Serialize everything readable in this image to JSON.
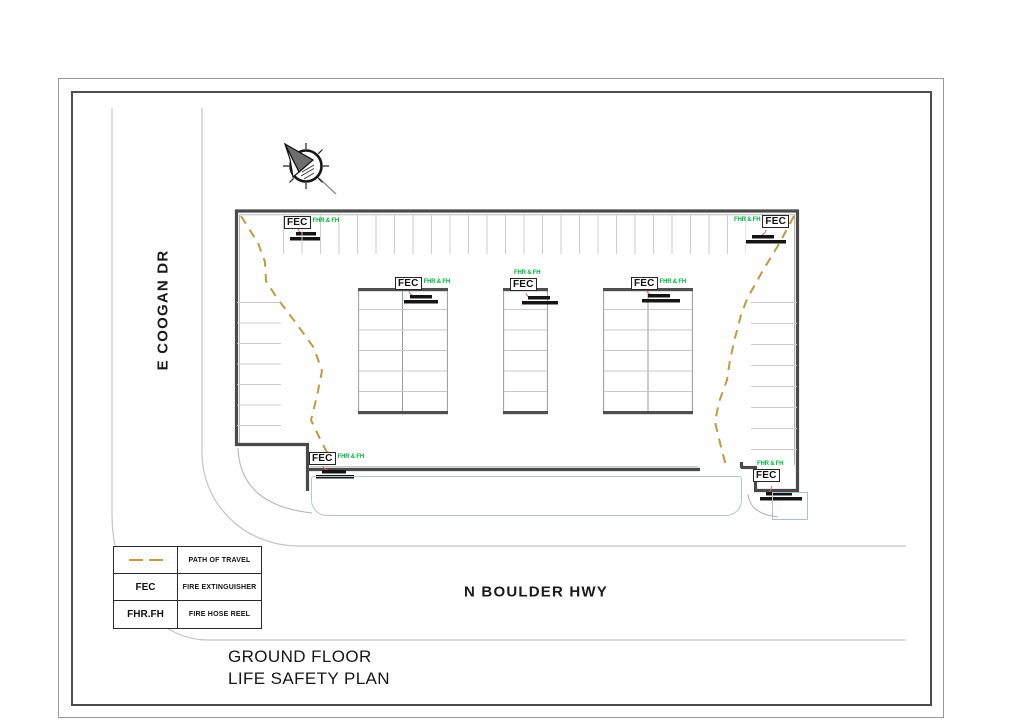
{
  "plan": {
    "streets": {
      "left_street": "E COOGAN DR",
      "bottom_street": "N BOULDER HWY"
    },
    "title_line1": "GROUND FLOOR",
    "title_line2": "LIFE SAFETY PLAN"
  },
  "fec": {
    "label": "FEC",
    "tag": "FHR & FH"
  },
  "legend": {
    "rows": [
      {
        "symbol": "dashed-line",
        "label": "PATH OF TRAVEL"
      },
      {
        "symbol": "FEC",
        "label": "FIRE EXTINGUISHER"
      },
      {
        "symbol": "FHR.FH",
        "label": "FIRE HOSE REEL"
      }
    ]
  },
  "colors": {
    "path_of_travel": "#c19a3f",
    "fec_tag_green": "#00b33c",
    "leader_red": "#e06666",
    "wall": "#4f4f4f",
    "stall_line": "#cccccc",
    "street_line": "#c4c4c4",
    "canopy": "#b7c6d1"
  }
}
